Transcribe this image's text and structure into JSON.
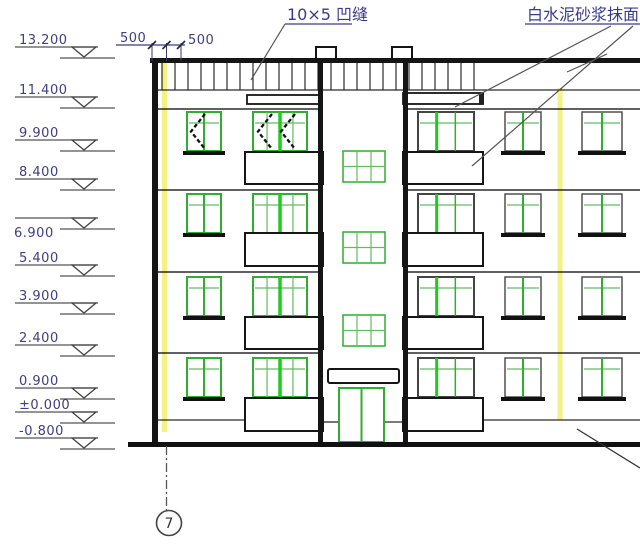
{
  "drawing_type": "building-elevation",
  "annotations": {
    "groove_label": "10×5 凹缝",
    "plaster_label": "白水泥砂浆抹面"
  },
  "dimension": {
    "labels": [
      "500",
      "500"
    ]
  },
  "axis_bubble": {
    "label": "7"
  },
  "levels": [
    {
      "label": "13.200",
      "y": 47
    },
    {
      "label": "11.400",
      "y": 97
    },
    {
      "label": "9.900",
      "y": 140
    },
    {
      "label": "8.400",
      "y": 179
    },
    {
      "label": "6.900",
      "y": 218,
      "text_below": true
    },
    {
      "label": "5.400",
      "y": 265
    },
    {
      "label": "3.900",
      "y": 303
    },
    {
      "label": "2.400",
      "y": 345
    },
    {
      "label": "0.900",
      "y": 388
    },
    {
      "label": "±0.000",
      "y": 412
    },
    {
      "label": "-0.800",
      "y": 438
    }
  ],
  "colors": {
    "line": "#1c1c1c",
    "thin_line": "#2b2b2b",
    "mark_line": "#555555",
    "text_blue": "#3f3f82",
    "window_green": "#2fae2f",
    "bright_green": "#1ecc1e",
    "light_green": "#63bc63",
    "dark_frame": "#444444",
    "highlight_yellow": "#f2f06e"
  },
  "geometry": {
    "floors_y": [
      112,
      194,
      277,
      358
    ],
    "window_h": 39,
    "floor_lines_y": [
      109,
      190,
      272,
      353
    ],
    "left_windows": [
      {
        "x": 187,
        "w": 34,
        "style": "narrow"
      },
      {
        "x": 253,
        "w": 54,
        "style": "wide"
      }
    ],
    "right_windows": [
      {
        "x": 418,
        "w": 56,
        "style": "wide3"
      },
      {
        "x": 505,
        "w": 36,
        "style": "rnarrow"
      },
      {
        "x": 582,
        "w": 40,
        "style": "rnarrow"
      }
    ],
    "sills": {
      "left_narrow": {
        "x": 183,
        "w": 42
      },
      "right": [
        {
          "x": 501,
          "w": 44
        },
        {
          "x": 578,
          "w": 48
        }
      ]
    },
    "tower_windows": {
      "x": 343,
      "w": 42,
      "h": 31,
      "rows_y": [
        151,
        232,
        315
      ]
    },
    "balconies": {
      "left_x": 245,
      "left_w": 78,
      "right_x": 403,
      "right_w": 80,
      "rows": [
        {
          "y": 152,
          "h": 32
        },
        {
          "y": 233,
          "h": 33
        },
        {
          "y": 317,
          "h": 32
        },
        {
          "y": 398,
          "h": 33
        }
      ]
    },
    "roof_slabs": [
      {
        "x": 247,
        "y": 95,
        "w": 75,
        "h": 9
      },
      {
        "x": 403,
        "y": 93,
        "w": 80,
        "h": 11
      }
    ],
    "chevrons": [
      {
        "tip": 205,
        "apex": 191
      },
      {
        "tip": 272,
        "apex": 258
      },
      {
        "tip": 295,
        "apex": 281
      }
    ],
    "hatch": {
      "x0": 162,
      "x1": 479,
      "step": 13,
      "y0": 63,
      "y1": 90
    },
    "dim_ticks_x": [
      152,
      166.5,
      181
    ]
  }
}
